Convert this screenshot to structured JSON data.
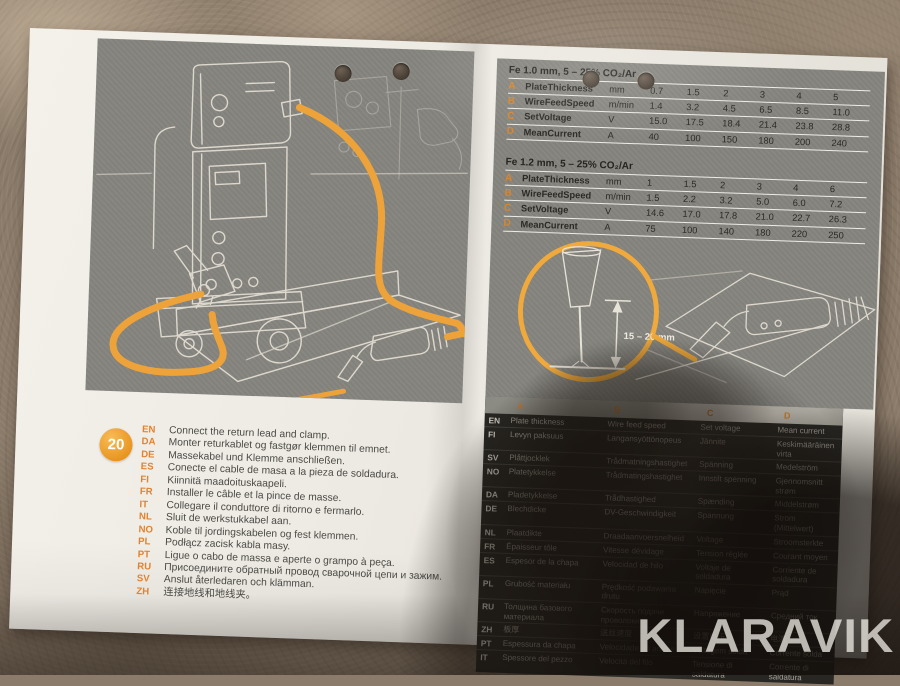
{
  "photo": {
    "watermark": "KLARAVIK"
  },
  "sheet": {
    "step_number": "20",
    "callout_dimension": "15 – 20 mm",
    "settings_tables": [
      {
        "title": "Fe 1.0 mm, 5 – 25% CO₂/Ar",
        "rows": [
          {
            "key": "A",
            "label": "PlateThickness",
            "unit": "mm",
            "values": [
              "0.7",
              "1.5",
              "2",
              "3",
              "4",
              "5"
            ]
          },
          {
            "key": "B",
            "label": "WireFeedSpeed",
            "unit": "m/min",
            "values": [
              "1.4",
              "3.2",
              "4.5",
              "6.5",
              "8.5",
              "11.0"
            ]
          },
          {
            "key": "C",
            "label": "SetVoltage",
            "unit": "V",
            "values": [
              "15.0",
              "17.5",
              "18.4",
              "21.4",
              "23.8",
              "28.8"
            ]
          },
          {
            "key": "D",
            "label": "MeanCurrent",
            "unit": "A",
            "values": [
              "40",
              "100",
              "150",
              "180",
              "200",
              "240"
            ]
          }
        ]
      },
      {
        "title": "Fe 1.2 mm, 5 – 25% CO₂/Ar",
        "rows": [
          {
            "key": "A",
            "label": "PlateThickness",
            "unit": "mm",
            "values": [
              "1",
              "1.5",
              "2",
              "3",
              "4",
              "6"
            ]
          },
          {
            "key": "B",
            "label": "WireFeedSpeed",
            "unit": "m/min",
            "values": [
              "1.5",
              "2.2",
              "3.2",
              "5.0",
              "6.0",
              "7.2"
            ]
          },
          {
            "key": "C",
            "label": "SetVoltage",
            "unit": "V",
            "values": [
              "14.6",
              "17.0",
              "17.8",
              "21.0",
              "22.7",
              "26.3"
            ]
          },
          {
            "key": "D",
            "label": "MeanCurrent",
            "unit": "A",
            "values": [
              "75",
              "100",
              "140",
              "180",
              "220",
              "250"
            ]
          }
        ]
      }
    ],
    "instructions": [
      {
        "code": "EN",
        "text": "Connect the return lead and clamp."
      },
      {
        "code": "DA",
        "text": "Monter returkablet og fastgør klemmen til emnet."
      },
      {
        "code": "DE",
        "text": "Massekabel und Klemme anschließen."
      },
      {
        "code": "ES",
        "text": "Conecte el cable de masa a la pieza de soldadura."
      },
      {
        "code": "FI",
        "text": "Kiinnitä maadoituskaapeli."
      },
      {
        "code": "FR",
        "text": "Installer le câble et la pince de masse."
      },
      {
        "code": "IT",
        "text": "Collegare il conduttore di ritorno e fermarlo."
      },
      {
        "code": "NL",
        "text": "Sluit de werkstukkabel aan."
      },
      {
        "code": "NO",
        "text": "Koble til jordingskabelen og fest klemmen."
      },
      {
        "code": "PL",
        "text": "Podłącz zacisk kabla masy."
      },
      {
        "code": "PT",
        "text": "Ligue o cabo de massa e aperte o grampo à peça."
      },
      {
        "code": "RU",
        "text": "Присоедините обратный провод сварочной цепи и зажим."
      },
      {
        "code": "SV",
        "text": "Anslut återledaren och klämman."
      },
      {
        "code": "ZH",
        "text": "连接地线和地线夹。"
      }
    ],
    "glossary": {
      "headers": [
        "A",
        "B",
        "C",
        "D"
      ],
      "rows": [
        {
          "code": "EN",
          "cells": [
            "Plate thickness",
            "Wire feed speed",
            "Set voltage",
            "Mean current"
          ]
        },
        {
          "code": "FI",
          "cells": [
            "Levyn paksuus",
            "Langansyöttönopeus",
            "Jännite",
            "Keskimääräinen virta"
          ]
        },
        {
          "code": "SV",
          "cells": [
            "Plåttjocklek",
            "Trådmatningshastighet",
            "Spänning",
            "Medelström"
          ]
        },
        {
          "code": "NO",
          "cells": [
            "Platetykkelse",
            "Trådmatingshastighet",
            "Innstilt spenning",
            "Gjennomsnitt strøm"
          ]
        },
        {
          "code": "DA",
          "cells": [
            "Pladetykkelse",
            "Trådhastighed",
            "Spænding",
            "Middelstrøm"
          ]
        },
        {
          "code": "DE",
          "cells": [
            "Blechdicke",
            "DV-Geschwindigkeit",
            "Spannung",
            "Strom (Mittelwert)"
          ]
        },
        {
          "code": "NL",
          "cells": [
            "Plaatdikte",
            "Draadaanvoersnelheid",
            "Voltage",
            "Stroomsterkte"
          ]
        },
        {
          "code": "FR",
          "cells": [
            "Épaisseur tôle",
            "Vitesse dévidage",
            "Tension réglée",
            "Courant moyen"
          ]
        },
        {
          "code": "ES",
          "cells": [
            "Espesor de la chapa",
            "Velocidad de hilo",
            "Voltaje de soldadura",
            "Corriente de soldadura"
          ]
        },
        {
          "code": "PL",
          "cells": [
            "Grubość materiału",
            "Prędkość podawania drutu",
            "Napięcie",
            "Prąd"
          ]
        },
        {
          "code": "RU",
          "cells": [
            "Толщина базового материала",
            "Скорость подачи проволоки",
            "Напряжение",
            "Средний ток"
          ]
        },
        {
          "code": "ZH",
          "cells": [
            "板厚",
            "送丝速度",
            "设置电压",
            "电流"
          ]
        },
        {
          "code": "PT",
          "cells": [
            "Espessura da chapa",
            "Velocidade do arame",
            "Voltagem solda",
            "Corrente solda"
          ]
        },
        {
          "code": "IT",
          "cells": [
            "Spessore del pezzo",
            "Velocità del filo",
            "Tensione di saldatura",
            "Corrente di saldatura"
          ]
        }
      ]
    }
  },
  "colors": {
    "accent": "#ED9B33",
    "panel_gray": "#85847E",
    "table_dark": "#282723"
  }
}
